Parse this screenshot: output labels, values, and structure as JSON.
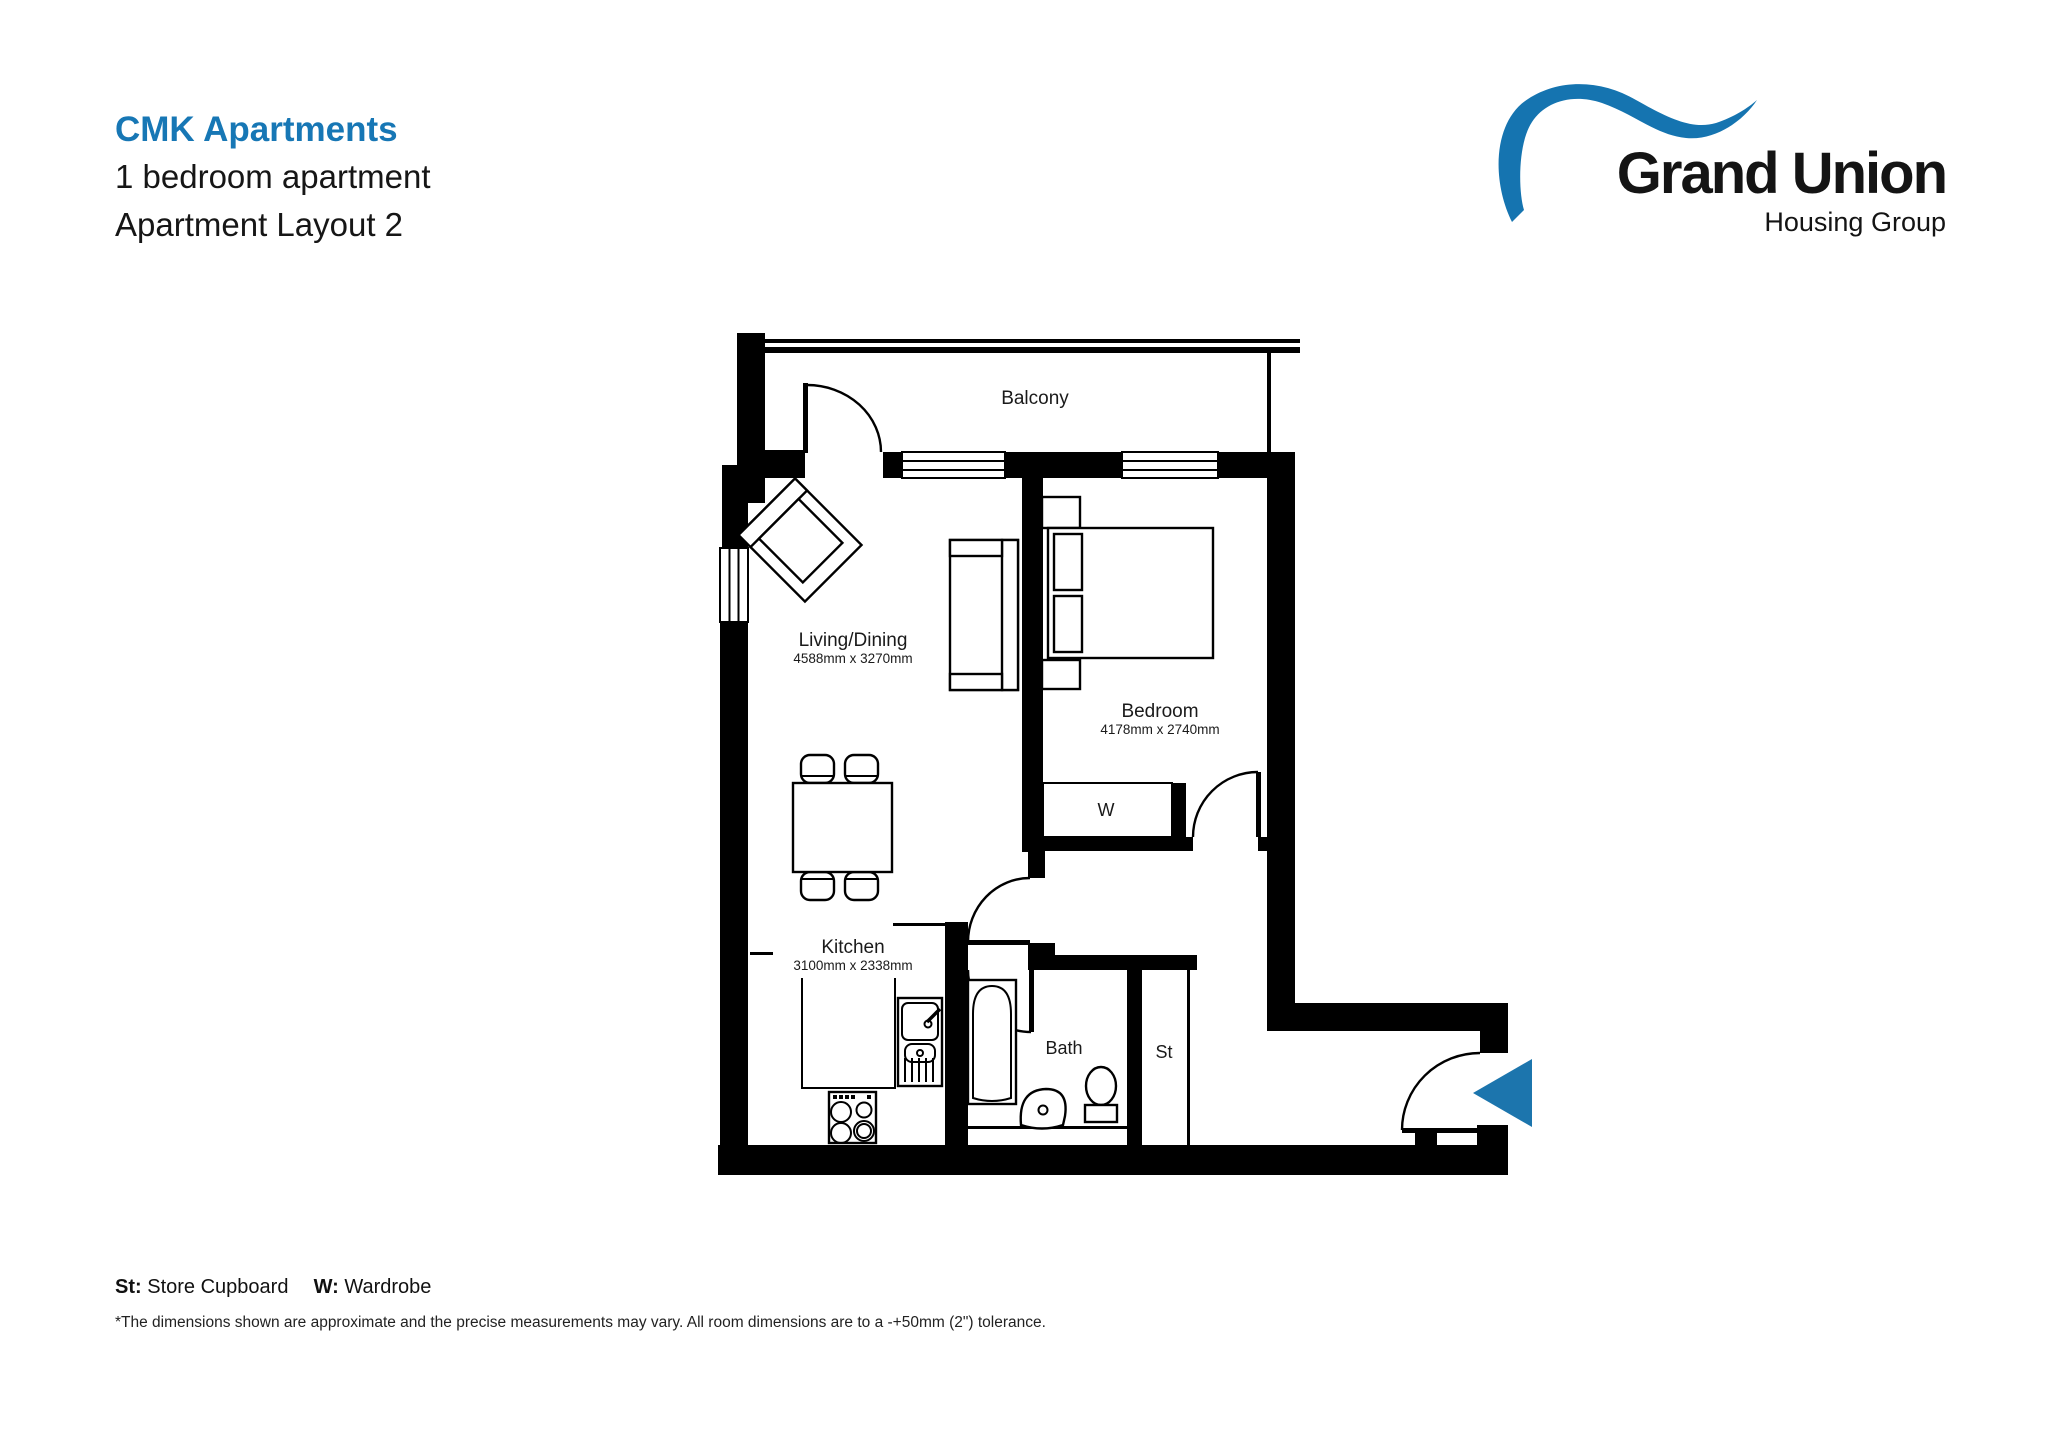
{
  "header": {
    "project": "CMK Apartments",
    "subtitle": "1 bedroom apartment",
    "layout": "Apartment Layout 2"
  },
  "logo": {
    "name": "Grand Union",
    "tagline": "Housing Group"
  },
  "plan": {
    "balcony_label": "Balcony",
    "rooms": {
      "living": {
        "name": "Living/Dining",
        "dims": "4588mm x 3270mm"
      },
      "bedroom": {
        "name": "Bedroom",
        "dims": "4178mm x 2740mm"
      },
      "kitchen": {
        "name": "Kitchen",
        "dims": "3100mm x 2338mm"
      },
      "bath": {
        "name": "Bath"
      },
      "store": {
        "abbr": "St"
      },
      "wardrobe": {
        "abbr": "W"
      }
    }
  },
  "legend": {
    "st_abbr": "St:",
    "st_label": "Store Cupboard",
    "w_abbr": "W:",
    "w_label": "Wardrobe"
  },
  "disclaimer": "*The dimensions shown are approximate and the precise measurements may vary. All room dimensions are to a -+50mm (2\") tolerance.",
  "colors": {
    "accent_blue": "#1777b5",
    "logo_blue": "#1574b0",
    "arrow_blue": "#1c75ad",
    "wall_black": "#000000"
  }
}
